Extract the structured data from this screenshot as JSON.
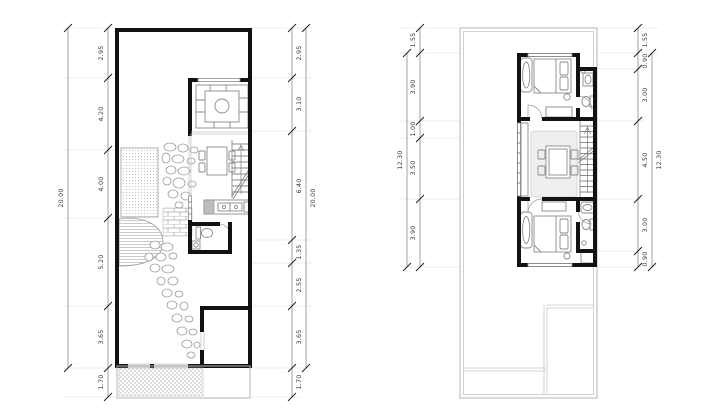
{
  "page": {
    "background": "#ffffff",
    "wall_color": "#121212",
    "furniture_line_color": "#8a8a8a",
    "thin_outline_color": "#b5b5b5"
  },
  "plans": [
    {
      "label": "ground-floor-plan",
      "total_left": "20.00",
      "total_right": "20.00",
      "dims_left": [
        "2.95",
        "4.20",
        "4.00",
        "5.20",
        "3.65",
        "1.70"
      ],
      "dims_right": [
        "2.95",
        "3.10",
        "6.40",
        "1.35",
        "2.55",
        "3.65",
        "1.70"
      ]
    },
    {
      "label": "upper-floor-plan",
      "total_left": "12.30",
      "total_right": "12.30",
      "dims_left": [
        "1.55",
        "3.90",
        "1.00",
        "3.50",
        "3.90"
      ],
      "dims_right": [
        "1.55",
        "0.90",
        "3.00",
        "4.50",
        "3.00",
        "0.90"
      ]
    }
  ]
}
